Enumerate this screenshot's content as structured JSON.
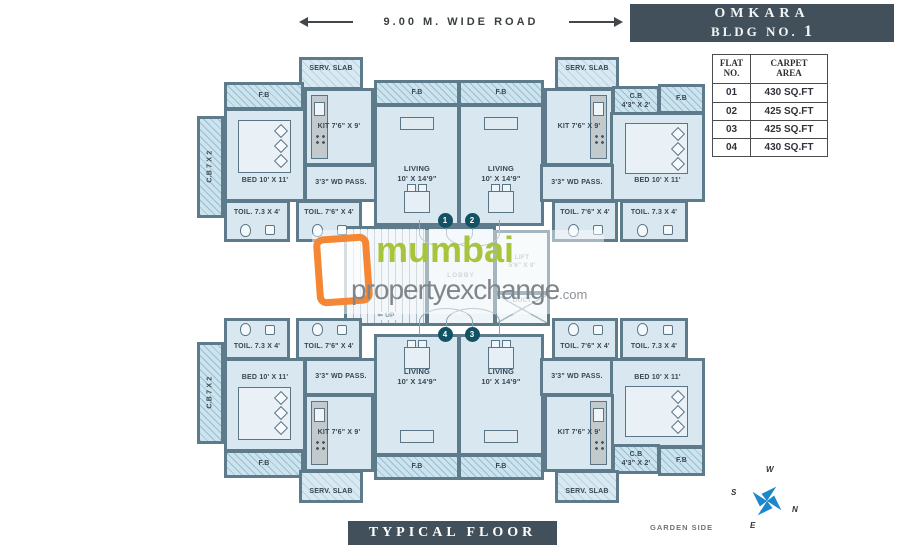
{
  "road": {
    "label": "9.00 M. WIDE ROAD"
  },
  "header": {
    "building_name": "OMKARA",
    "bldg_prefix": "BLDG NO.",
    "bldg_no": "1"
  },
  "table": {
    "col1_header": "FLAT\nNO.",
    "col2_header": "CARPET\nAREA",
    "rows": [
      [
        "01",
        "430 SQ.FT"
      ],
      [
        "02",
        "425 SQ.FT"
      ],
      [
        "03",
        "425 SQ.FT"
      ],
      [
        "04",
        "430 SQ.FT"
      ]
    ]
  },
  "watermark": {
    "line1": "mumbai",
    "line2": "propertyexchange",
    "suffix": ".com"
  },
  "footer": {
    "title": "TYPICAL FLOOR PLAN",
    "garden_side": "GARDEN SIDE"
  },
  "compass": {
    "n": "N",
    "s": "S",
    "e": "E",
    "w": "W"
  },
  "colors": {
    "wall": "#5e7b8b",
    "room_fill": "#d9e8f0",
    "hatch_fill": "#cde3ee",
    "dark_panel": "#41505a",
    "badge": "#135264",
    "logo_orange": "#f58634",
    "logo_green": "#a8c43c",
    "logo_gray": "#7f868b",
    "compass_blue": "#1e86cb"
  },
  "plan": {
    "rooms": [
      {
        "id": "serv-slab-1",
        "type": "serv",
        "x": 299,
        "y": 57,
        "w": 64,
        "h": 33,
        "lines": [
          "SERV. SLAB"
        ]
      },
      {
        "id": "fb-bed-1",
        "type": "fb",
        "x": 224,
        "y": 82,
        "w": 80,
        "h": 28,
        "lines": [
          "F.B"
        ]
      },
      {
        "id": "cb-1",
        "type": "cb",
        "x": 197,
        "y": 116,
        "w": 27,
        "h": 102,
        "lines": [
          "C.B  7 X 2"
        ]
      },
      {
        "id": "bed-1",
        "type": "bed",
        "x": 224,
        "y": 108,
        "w": 82,
        "h": 94,
        "lines": [
          "BED 10' X 11'"
        ]
      },
      {
        "id": "kit-1",
        "type": "kit",
        "x": 304,
        "y": 88,
        "w": 70,
        "h": 78,
        "lines": [
          "KIT 7'6\" X 9'"
        ]
      },
      {
        "id": "pass-1",
        "type": "pass",
        "x": 304,
        "y": 164,
        "w": 74,
        "h": 38,
        "lines": [
          "3'3\" WD PASS."
        ]
      },
      {
        "id": "toil-1a",
        "type": "toil",
        "x": 224,
        "y": 200,
        "w": 66,
        "h": 42,
        "lines": [
          "TOIL. 7.3 X 4'"
        ]
      },
      {
        "id": "toil-1b",
        "type": "toil",
        "x": 296,
        "y": 200,
        "w": 66,
        "h": 42,
        "lines": [
          "TOIL. 7'6\" X 4'"
        ]
      },
      {
        "id": "fb-liv-1",
        "type": "fb",
        "x": 374,
        "y": 80,
        "w": 86,
        "h": 26,
        "lines": [
          "F.B"
        ]
      },
      {
        "id": "liv-1",
        "type": "liv",
        "x": 374,
        "y": 104,
        "w": 86,
        "h": 122,
        "lines": [
          "LIVING",
          "10' X 14'9\""
        ]
      },
      {
        "id": "fb-liv-2",
        "type": "fb",
        "x": 458,
        "y": 80,
        "w": 86,
        "h": 26,
        "lines": [
          "F.B"
        ]
      },
      {
        "id": "liv-2",
        "type": "liv",
        "x": 458,
        "y": 104,
        "w": 86,
        "h": 122,
        "lines": [
          "LIVING",
          "10' X 14'9\""
        ]
      },
      {
        "id": "serv-slab-2",
        "type": "serv",
        "x": 555,
        "y": 57,
        "w": 64,
        "h": 33,
        "lines": [
          "SERV. SLAB"
        ]
      },
      {
        "id": "kit-2",
        "type": "kit",
        "variant": "right",
        "x": 544,
        "y": 88,
        "w": 70,
        "h": 78,
        "lines": [
          "KIT 7'6\" X 9'"
        ]
      },
      {
        "id": "cb-2",
        "type": "cb2",
        "x": 612,
        "y": 86,
        "w": 48,
        "h": 30,
        "lines": [
          "C.B",
          "4'3\" X 2'"
        ]
      },
      {
        "id": "fb-2",
        "type": "fb",
        "x": 658,
        "y": 84,
        "w": 47,
        "h": 30,
        "lines": [
          "F.B"
        ]
      },
      {
        "id": "bed-2",
        "type": "bed",
        "x": 610,
        "y": 112,
        "w": 95,
        "h": 90,
        "lines": [
          "BED 10' X 11'"
        ]
      },
      {
        "id": "pass-2",
        "type": "pass",
        "x": 540,
        "y": 164,
        "w": 74,
        "h": 38,
        "lines": [
          "3'3\" WD PASS."
        ]
      },
      {
        "id": "toil-2a",
        "type": "toil",
        "x": 552,
        "y": 200,
        "w": 66,
        "h": 42,
        "lines": [
          "TOIL. 7'6\" X 4'"
        ]
      },
      {
        "id": "toil-2b",
        "type": "toil",
        "x": 620,
        "y": 200,
        "w": 68,
        "h": 42,
        "lines": [
          "TOIL. 7.3 X 4'"
        ]
      },
      {
        "id": "stair",
        "type": "stair",
        "x": 344,
        "y": 226,
        "w": 84,
        "h": 100,
        "lines": [
          "⇐ UP"
        ]
      },
      {
        "id": "lobby",
        "type": "lobby",
        "x": 426,
        "y": 226,
        "w": 70,
        "h": 100,
        "lines": [
          "LOBBY"
        ]
      },
      {
        "id": "lift",
        "type": "lift",
        "x": 494,
        "y": 230,
        "w": 56,
        "h": 64,
        "lines": [
          "LIFT",
          "5'6\" X 9'"
        ]
      },
      {
        "id": "duct",
        "type": "duct",
        "x": 494,
        "y": 292,
        "w": 56,
        "h": 34,
        "lines": [
          "DUCT"
        ]
      },
      {
        "id": "toil-4a",
        "type": "toil",
        "variant": "bottom",
        "x": 224,
        "y": 318,
        "w": 66,
        "h": 42,
        "lines": [
          "TOIL. 7.3 X 4'"
        ]
      },
      {
        "id": "toil-4b",
        "type": "toil",
        "variant": "bottom",
        "x": 296,
        "y": 318,
        "w": 66,
        "h": 42,
        "lines": [
          "TOIL. 7'6\" X 4'"
        ]
      },
      {
        "id": "pass-4",
        "type": "pass",
        "x": 304,
        "y": 358,
        "w": 74,
        "h": 38,
        "lines": [
          "3'3\" WD PASS."
        ]
      },
      {
        "id": "cb-4",
        "type": "cb",
        "x": 197,
        "y": 342,
        "w": 27,
        "h": 102,
        "lines": [
          "C.B  7 X 2"
        ]
      },
      {
        "id": "bed-4",
        "type": "bed",
        "variant": "bottom",
        "x": 224,
        "y": 358,
        "w": 82,
        "h": 94,
        "lines": [
          "BED 10' X 11'"
        ]
      },
      {
        "id": "kit-4",
        "type": "kit",
        "x": 304,
        "y": 394,
        "w": 70,
        "h": 78,
        "lines": [
          "KIT 7'6\" X 9'"
        ]
      },
      {
        "id": "fb-bed-4",
        "type": "fb",
        "x": 224,
        "y": 450,
        "w": 80,
        "h": 28,
        "lines": [
          "F.B"
        ]
      },
      {
        "id": "serv-slab-4",
        "type": "serv",
        "variant": "bottom",
        "x": 299,
        "y": 470,
        "w": 64,
        "h": 33,
        "lines": [
          "SERV. SLAB"
        ]
      },
      {
        "id": "liv-4",
        "type": "liv",
        "variant": "bottom",
        "x": 374,
        "y": 334,
        "w": 86,
        "h": 122,
        "lines": [
          "LIVING",
          "10' X 14'9\""
        ]
      },
      {
        "id": "fb-liv-4",
        "type": "fb",
        "x": 374,
        "y": 454,
        "w": 86,
        "h": 26,
        "lines": [
          "F.B"
        ]
      },
      {
        "id": "liv-3",
        "type": "liv",
        "variant": "bottom",
        "x": 458,
        "y": 334,
        "w": 86,
        "h": 122,
        "lines": [
          "LIVING",
          "10' X 14'9\""
        ]
      },
      {
        "id": "fb-liv-3",
        "type": "fb",
        "x": 458,
        "y": 454,
        "w": 86,
        "h": 26,
        "lines": [
          "F.B"
        ]
      },
      {
        "id": "toil-3a",
        "type": "toil",
        "variant": "bottom",
        "x": 552,
        "y": 318,
        "w": 66,
        "h": 42,
        "lines": [
          "TOIL. 7'6\" X 4'"
        ]
      },
      {
        "id": "toil-3b",
        "type": "toil",
        "variant": "bottom",
        "x": 620,
        "y": 318,
        "w": 68,
        "h": 42,
        "lines": [
          "TOIL. 7.3 X 4'"
        ]
      },
      {
        "id": "pass-3",
        "type": "pass",
        "x": 540,
        "y": 358,
        "w": 74,
        "h": 38,
        "lines": [
          "3'3\" WD PASS."
        ]
      },
      {
        "id": "bed-3",
        "type": "bed",
        "variant": "bottom",
        "x": 610,
        "y": 358,
        "w": 95,
        "h": 90,
        "lines": [
          "BED 10' X 11'"
        ]
      },
      {
        "id": "kit-3",
        "type": "kit",
        "variant": "right",
        "x": 544,
        "y": 394,
        "w": 70,
        "h": 78,
        "lines": [
          "KIT 7'6\" X 9'"
        ]
      },
      {
        "id": "cb-3",
        "type": "cb2",
        "x": 612,
        "y": 444,
        "w": 48,
        "h": 30,
        "lines": [
          "C.B",
          "4'3\" X 2'"
        ]
      },
      {
        "id": "fb-3",
        "type": "fb",
        "x": 658,
        "y": 446,
        "w": 47,
        "h": 30,
        "lines": [
          "F.B"
        ]
      },
      {
        "id": "serv-slab-3",
        "type": "serv",
        "variant": "bottom",
        "x": 555,
        "y": 470,
        "w": 64,
        "h": 33,
        "lines": [
          "SERV. SLAB"
        ]
      }
    ],
    "badges": [
      {
        "no": "1",
        "x": 445,
        "y": 220
      },
      {
        "no": "2",
        "x": 472,
        "y": 220
      },
      {
        "no": "4",
        "x": 445,
        "y": 334
      },
      {
        "no": "3",
        "x": 472,
        "y": 334
      }
    ]
  }
}
